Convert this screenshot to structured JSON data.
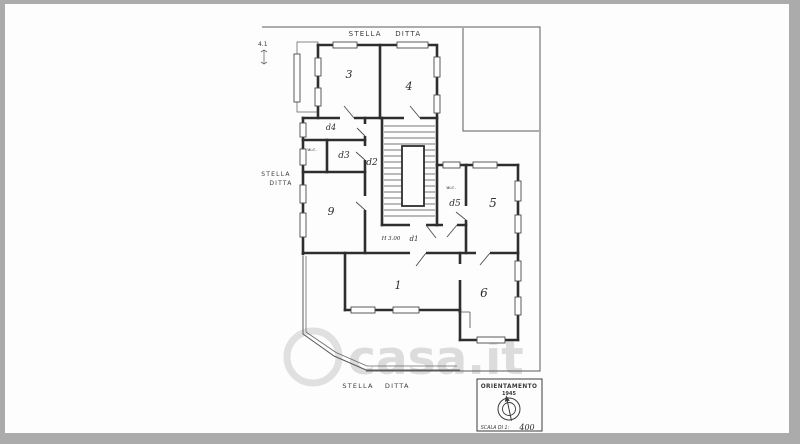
{
  "colors": {
    "background": "#ababab",
    "paper": "#fdfdfd",
    "ink": "#2e2e2e",
    "watermark_gray": "#bdbdbd"
  },
  "labels": {
    "north_boundary": "STELLA DITTA",
    "west_boundary_line1": "STELLA",
    "west_boundary_line2": "DITTA",
    "south_boundary": "STELLA DITTA",
    "dimension_note": "4.1"
  },
  "rooms": {
    "room3": "3",
    "room4": "4",
    "closet_d4": "d4",
    "wc_west": "w.c.",
    "closet_d3": "d3",
    "hall_d2": "d2",
    "room9": "9",
    "wc_east": "w.c.",
    "closet_d5": "d5",
    "room5": "5",
    "room1": "1",
    "room6": "6",
    "hall_d1": "d1",
    "ceiling_height": "H 3.00"
  },
  "orientation_box": {
    "title": "ORIENTAMENTO",
    "subtitle": "1945",
    "scale_prefix": "SCALA DI 1:",
    "scale_value": "400"
  },
  "watermark": {
    "text": "casa.it"
  }
}
